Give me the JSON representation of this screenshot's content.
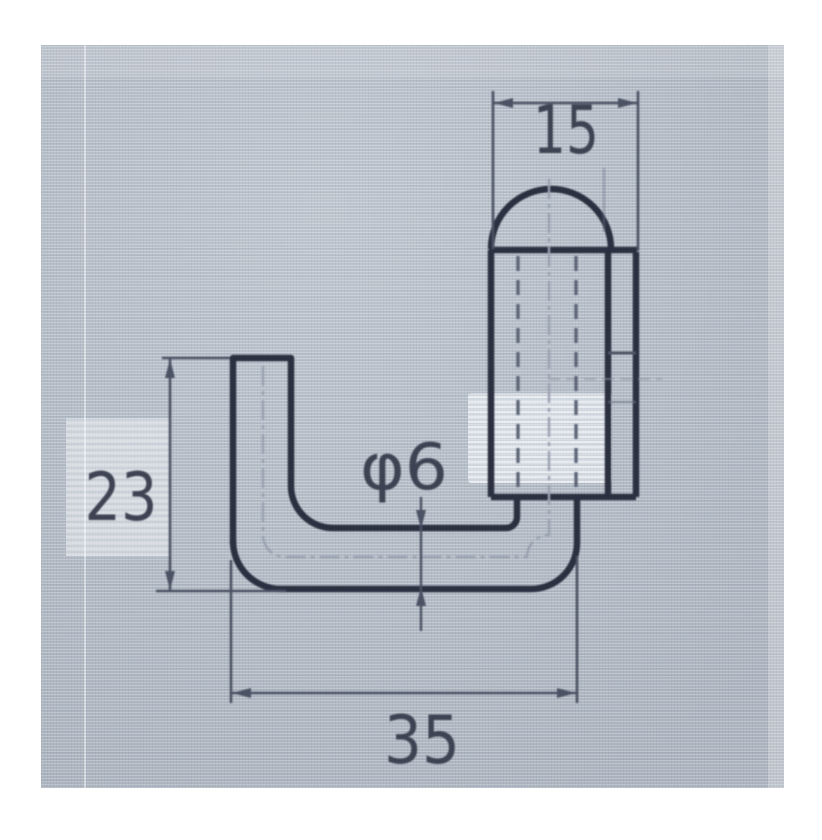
{
  "drawing": {
    "dim_top_width": "15",
    "dim_left_height": "23",
    "dim_bottom_width": "35",
    "dim_rod_diameter": "φ6"
  },
  "colors": {
    "page_bg": "#ffffff",
    "photo_bg": "#b5bec9",
    "outline": "#2b3040",
    "dim_line": "#4b5264",
    "centerline": "#99a1b1",
    "hidden_line": "#5d6577",
    "text": "#3d4352"
  }
}
